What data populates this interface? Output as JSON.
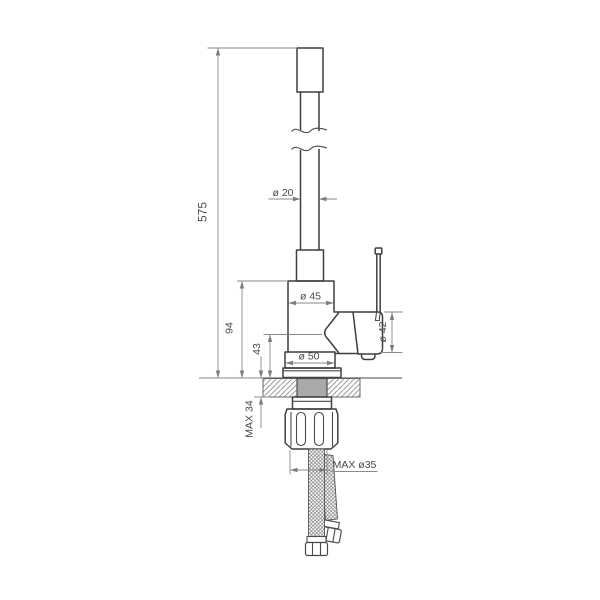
{
  "drawing_title": "faucet-dimension-drawing",
  "labels": {
    "total_height": "575",
    "spout_pipe_diameter": "ø 20",
    "body_diameter": "ø 45",
    "body_height": "94",
    "outlet_height": "43",
    "base_diameter": "ø 50",
    "cartridge_diameter": "ø 42",
    "max_mounting_thickness": "MAX 34",
    "max_hole_diameter": "MAX ø35"
  },
  "colors": {
    "outline": "#3f3f3f",
    "dimension_lines": "#8a8a8a",
    "text": "#4a4a4a",
    "shank_fill": "#a9a9a9",
    "background": "#ffffff"
  }
}
